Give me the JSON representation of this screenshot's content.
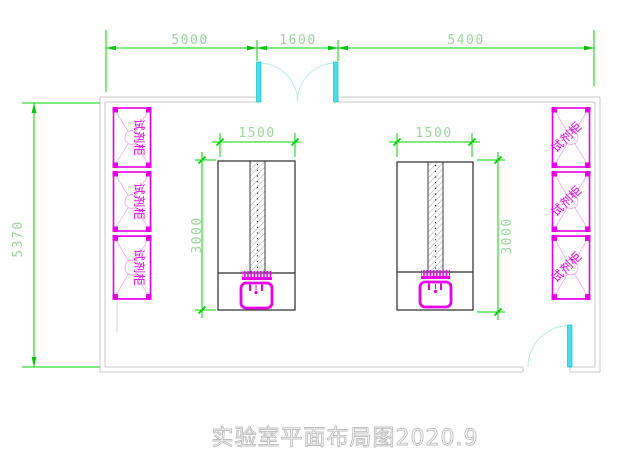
{
  "plan": {
    "title": "实验室平面布局图2020.9",
    "dims": {
      "top_left": "5000",
      "top_middle": "1600",
      "top_right": "5400",
      "room_depth": "5370",
      "bench_width": "1500",
      "bench_depth": "3000"
    },
    "labels": {
      "reagent_cabinet": "试剂柜"
    },
    "counts": {
      "left_cabinets": 3,
      "right_cabinets": 3,
      "benches": 2
    },
    "colors": {
      "dimension_line_green": "#00d400",
      "dimension_text_green": "#9bd69b",
      "cabinet_magenta": "#e800e8",
      "cabinet_light_magenta": "#f6a6f6",
      "door_cyan": "#49dfe8",
      "door_swing_cyan": "#b5ecf2",
      "wall_gray": "#c9c9c9",
      "bench_outline_black": "#2a2a2a",
      "title_gray": "#bdbdbd"
    }
  }
}
